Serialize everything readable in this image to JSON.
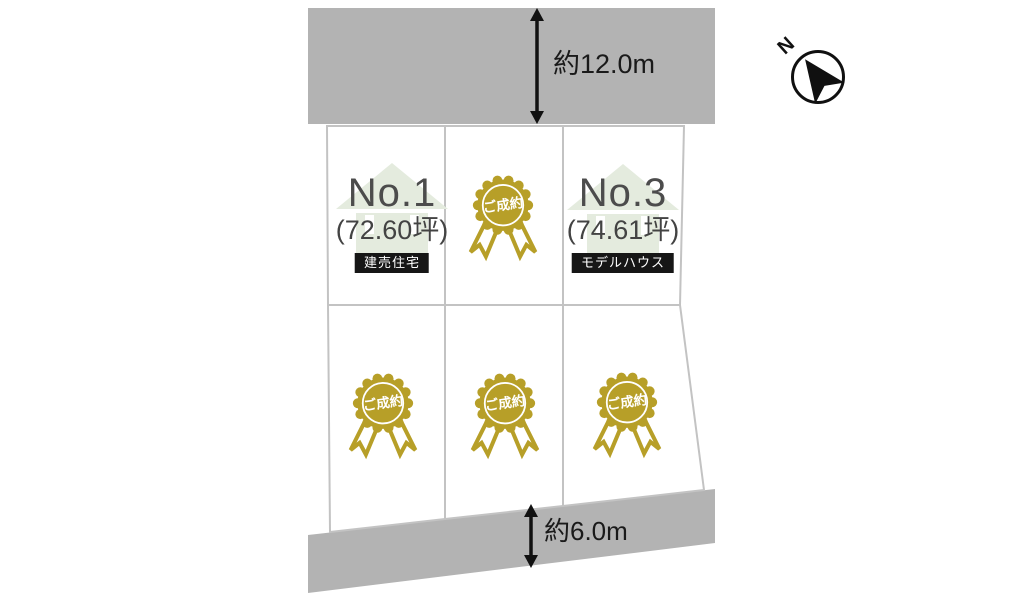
{
  "plan": {
    "compass_label": "N",
    "road_top_dimension": "約12.0m",
    "road_bottom_dimension": "約6.0m",
    "sold_label": "ご成約",
    "lots": [
      {
        "position": "top-left",
        "number": "No.1",
        "area": "(72.60坪)",
        "badge": "建売住宅"
      },
      {
        "position": "top-middle",
        "status": "ご成約"
      },
      {
        "position": "top-right",
        "number": "No.3",
        "area": "(74.61坪)",
        "badge": "モデルハウス"
      },
      {
        "position": "bottom-left",
        "status": "ご成約"
      },
      {
        "position": "bottom-middle",
        "status": "ご成約"
      },
      {
        "position": "bottom-right",
        "status": "ご成約"
      }
    ],
    "colors": {
      "road_gray": "#b3b3b3",
      "lot_border": "#c3c3c3",
      "gold": "#b79f28",
      "house_green": "#e4ebde",
      "badge_bg": "#161616"
    }
  }
}
